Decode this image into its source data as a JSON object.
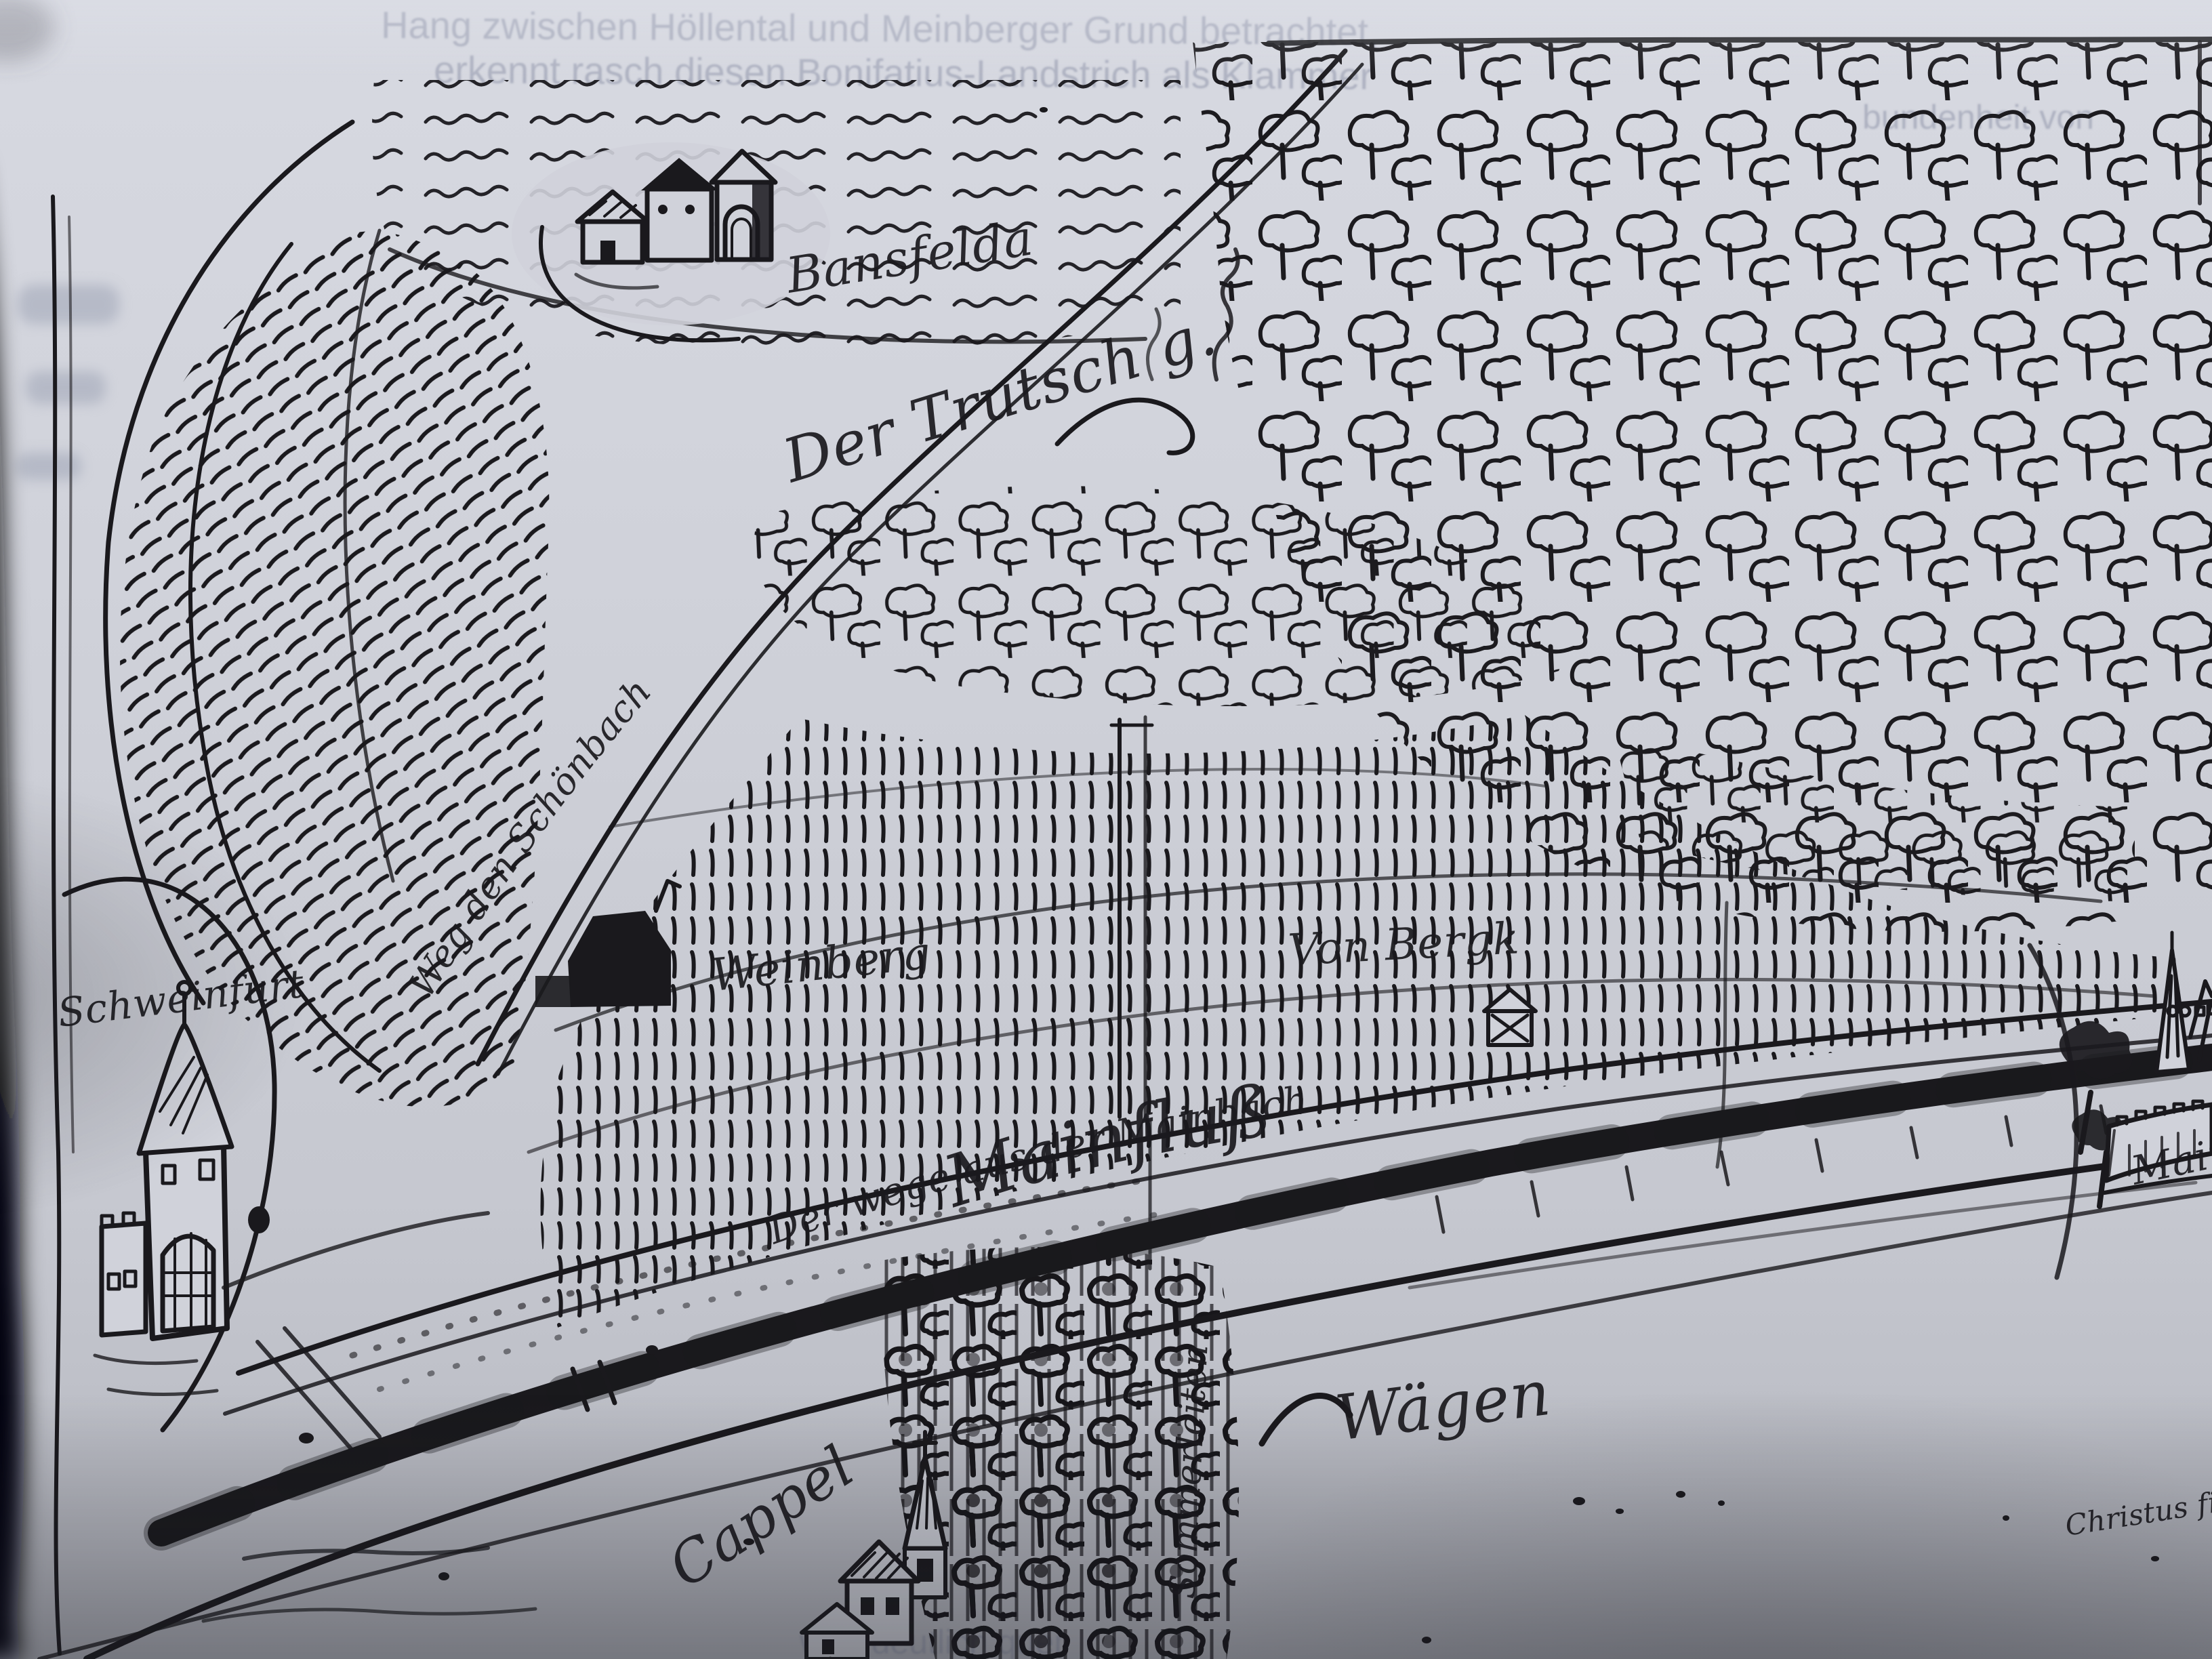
{
  "note": "Photograph of a book page reproducing a 16th-century pen-and-ink map of the Main river valley; handwritten labels transcribed approximately from old German script.",
  "colors": {
    "paper": "#d0d2da",
    "ink": "#1a191d",
    "shadow": "#0b0b0e",
    "ghost_print": "#8e94a8"
  },
  "labels": [
    {
      "id": "village-bansfelda",
      "text": "Bansfelda"
    },
    {
      "id": "der-trutsch",
      "text": "Der Trutsch g."
    },
    {
      "id": "weg-schoenbach",
      "text": "Weg den Schönbach"
    },
    {
      "id": "weinberg",
      "text": "Weinberg"
    },
    {
      "id": "von-berg",
      "text": "Von Bergk"
    },
    {
      "id": "weg-aus-mainbach",
      "text": "Der wege aus der Mainbach"
    },
    {
      "id": "mainfluss",
      "text": "Mainfluß"
    },
    {
      "id": "waegen",
      "text": "Wägen"
    },
    {
      "id": "cappel",
      "text": "Cappel"
    },
    {
      "id": "schweinfurt",
      "text": "Schweinfurt"
    },
    {
      "id": "mainberg",
      "text": "Mainberg"
    },
    {
      "id": "sommerleiten",
      "text": "Sommerleiten"
    },
    {
      "id": "annotation-corner",
      "text": "Christus fird"
    }
  ],
  "ghost_text": {
    "note": "faint printed text showing through the page",
    "lines": [
      {
        "text": "Hang zwischen Höllental und Meinberger Grund betrachtet,"
      },
      {
        "text": "erkennt rasch diesen Bonifatius-Landstrich als Klammer"
      },
      {
        "text": "bundenheit von"
      },
      {
        "text": "wird deutlich quer"
      }
    ]
  }
}
